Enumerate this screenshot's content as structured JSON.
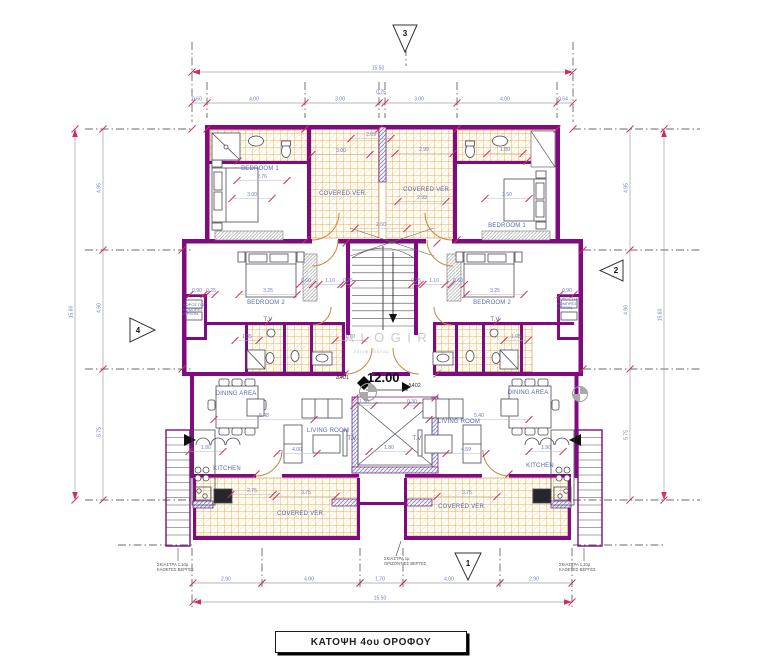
{
  "title_block": {
    "label": "ΚΑΤΟΨΗ  4ου ΟΡΟΦΟΥ"
  },
  "watermark": {
    "name": "KALOGIROU",
    "subtitle": "κατοψ. διανομ."
  },
  "level_marker": {
    "unit_left": "Δ401",
    "unit_right": "Δ402",
    "value": "12.00"
  },
  "markers": [
    {
      "id": "3",
      "points": "393,25 417,25 405,52",
      "tx": 405,
      "ty": 36
    },
    {
      "id": "2",
      "points": "623,260 623,281 600,270.5",
      "tx": 616,
      "ty": 273
    },
    {
      "id": "4",
      "points": "130,318 130,342 155,330",
      "tx": 138,
      "ty": 333
    },
    {
      "id": "1",
      "points": "455,553 481,553 468,580",
      "tx": 468,
      "ty": 566
    }
  ],
  "room_labels": [
    {
      "text": "BEDROOM  1",
      "x": 260,
      "y": 169
    },
    {
      "text": "BEDROOM  1",
      "x": 507,
      "y": 226
    },
    {
      "text": "BEDROOM 2",
      "x": 266,
      "y": 303
    },
    {
      "text": "BEDROOM 2",
      "x": 492,
      "y": 303
    },
    {
      "text": "COVERED VER.",
      "x": 343,
      "y": 194
    },
    {
      "text": "COVERED VER.",
      "x": 427,
      "y": 190
    },
    {
      "text": "COVERED VER.",
      "x": 301,
      "y": 514
    },
    {
      "text": "COVERED VER.",
      "x": 462,
      "y": 507
    },
    {
      "text": "LIVING ROOM",
      "x": 328,
      "y": 431
    },
    {
      "text": "LIVING ROOM",
      "x": 459,
      "y": 422
    },
    {
      "text": "DINING AREA",
      "x": 236,
      "y": 394
    },
    {
      "text": "DINING AREA",
      "x": 528,
      "y": 393
    },
    {
      "text": "KITCHEN",
      "x": 227,
      "y": 469
    },
    {
      "text": "KITCHEN",
      "x": 540,
      "y": 466
    },
    {
      "text": "T.V",
      "x": 268,
      "y": 320
    },
    {
      "text": "T.V",
      "x": 495,
      "y": 320
    },
    {
      "text": "T.V",
      "x": 352,
      "y": 439
    },
    {
      "text": "T.V",
      "x": 417,
      "y": 439
    }
  ],
  "side_notes": [
    {
      "lines": [
        "ΧΩΡΟΣ ΓΙΑ",
        "ΚΟΜΠΡΕΣ.",
        "ΑΙΡΚΟΝ."
      ],
      "x": 183,
      "y": 303
    },
    {
      "lines": [
        "ΧΩΡΟΣ ΓΙΑ",
        "ΚΟΜΠΡΕΣ.",
        "ΑΙΡΚΟΝ."
      ],
      "x": 557,
      "y": 297
    }
  ],
  "shade_notes": [
    {
      "lines": [
        "ΣΚΙΑΣΤΡΑ 1.10μ",
        "ΚΑΘΕΤΕΣ ΒΕΡΓΕΣ"
      ],
      "x": 157,
      "y": 562
    },
    {
      "lines": [
        "ΣΚΙΑΣΤΡΑ 1μ",
        "ΟΡΙΖΟΝΤΙΕΣ ΒΕΡΓΕΣ"
      ],
      "x": 384,
      "y": 556
    },
    {
      "lines": [
        "ΣΚΙΑΣΤΡΑ 1.10μ",
        "ΚΑΘΕΤΕΣ ΒΕΡΓΕΣ"
      ],
      "x": 559,
      "y": 562
    }
  ],
  "dim_chains": [
    {
      "o": "h",
      "y": 72,
      "x1": 192,
      "x2": 573,
      "ticks": [
        192,
        573
      ],
      "arrows": true,
      "labels": [
        {
          "t": "15.50",
          "at": 378
        }
      ]
    },
    {
      "o": "h",
      "y": 103,
      "x1": 192,
      "x2": 573,
      "ticks": [
        192,
        207,
        305,
        379,
        385,
        457,
        557,
        573
      ],
      "labels": [
        {
          "t": "0.60",
          "at": 197
        },
        {
          "t": "4.00",
          "at": 254
        },
        {
          "t": "3.00",
          "at": 340
        },
        {
          "t": "0.25",
          "at": 381,
          "off": -7
        },
        {
          "t": "3.00",
          "at": 419
        },
        {
          "t": "4.00",
          "at": 505
        },
        {
          "t": "0.64",
          "at": 563
        }
      ]
    },
    {
      "o": "h",
      "y": 583,
      "x1": 193,
      "x2": 572,
      "ticks": [
        193,
        262,
        360,
        403,
        500,
        572
      ],
      "labels": [
        {
          "t": "2.90",
          "at": 226
        },
        {
          "t": "4.00",
          "at": 309
        },
        {
          "t": "1.70",
          "at": 380
        },
        {
          "t": "4.00",
          "at": 449
        },
        {
          "t": "2.90",
          "at": 534
        }
      ]
    },
    {
      "o": "h",
      "y": 602,
      "x1": 193,
      "x2": 572,
      "ticks": [
        193,
        572
      ],
      "arrows": true,
      "labels": [
        {
          "t": "15.50",
          "at": 380
        }
      ]
    },
    {
      "o": "v",
      "x": 103,
      "y1": 129,
      "y2": 500,
      "ticks": [
        129,
        250,
        369,
        500
      ],
      "labels": [
        {
          "t": "4.95",
          "at": 188
        },
        {
          "t": "4.90",
          "at": 308
        },
        {
          "t": "5.75",
          "at": 432
        }
      ]
    },
    {
      "o": "v",
      "x": 75,
      "y1": 129,
      "y2": 500,
      "ticks": [
        129,
        500
      ],
      "arrows": true,
      "labels": [
        {
          "t": "15.60",
          "at": 312
        }
      ]
    },
    {
      "o": "v",
      "x": 630,
      "y1": 129,
      "y2": 500,
      "ticks": [
        129,
        250,
        369,
        500
      ],
      "labels": [
        {
          "t": "4.95",
          "at": 188
        },
        {
          "t": "4.90",
          "at": 310
        },
        {
          "t": "5.75",
          "at": 435
        }
      ]
    },
    {
      "o": "v",
      "x": 664,
      "y1": 129,
      "y2": 500,
      "ticks": [
        129,
        500
      ],
      "arrows": true,
      "labels": [
        {
          "t": "15.60",
          "at": 315
        }
      ]
    }
  ],
  "dims": [
    [
      "2.76",
      262,
      178,
      50
    ],
    [
      "2.09",
      371,
      136,
      40
    ],
    [
      "3.00",
      341,
      152,
      58
    ],
    [
      "2.99",
      424,
      151,
      58
    ],
    [
      "1.80",
      505,
      151,
      36
    ],
    [
      "3.00",
      252,
      196,
      40
    ],
    [
      "3.50",
      507,
      196,
      44
    ],
    [
      "2.99",
      422,
      199,
      48
    ],
    [
      "2.60",
      381,
      226,
      52
    ],
    [
      "3.25",
      268,
      292,
      58
    ],
    [
      "0.90",
      197,
      292,
      14
    ],
    [
      "0.25",
      211,
      292,
      8
    ],
    [
      "0.60",
      306,
      282,
      13
    ],
    [
      "1.10",
      330,
      282,
      22
    ],
    [
      "0.25",
      348,
      282,
      8
    ],
    [
      "3.25",
      495,
      292,
      58
    ],
    [
      "0.90",
      567,
      292,
      14
    ],
    [
      "0.25",
      416,
      282,
      8
    ],
    [
      "1.10",
      434,
      282,
      22
    ],
    [
      "0.60",
      458,
      282,
      13
    ],
    [
      "1.05",
      247,
      338,
      24
    ],
    [
      "1.70",
      350,
      338,
      30
    ],
    [
      "1.05",
      516,
      338,
      24
    ],
    [
      "5.48",
      264,
      417,
      100
    ],
    [
      "5.40",
      479,
      417,
      100
    ],
    [
      "4.00",
      297,
      451,
      40
    ],
    [
      "4.59",
      466,
      451,
      40
    ],
    [
      "1.80",
      206,
      449,
      34
    ],
    [
      "1.90",
      546,
      449,
      34
    ],
    [
      "2.75",
      252,
      492,
      42
    ],
    [
      "3.75",
      306,
      494,
      60
    ],
    [
      "3.75",
      467,
      494,
      60
    ],
    [
      "1.30",
      364,
      403,
      20
    ],
    [
      "0.30",
      412,
      403,
      10
    ],
    [
      "1.80",
      389,
      449,
      40
    ]
  ],
  "extra_ticks": [
    [
      207,
      129
    ],
    [
      305,
      129
    ],
    [
      379,
      129
    ],
    [
      457,
      129
    ],
    [
      557,
      129
    ],
    [
      192,
      129
    ],
    [
      573,
      129
    ],
    [
      182,
      250
    ],
    [
      583,
      250
    ],
    [
      182,
      369
    ],
    [
      583,
      369
    ],
    [
      262,
      583
    ],
    [
      360,
      583
    ],
    [
      403,
      583
    ],
    [
      500,
      583
    ],
    [
      346,
      243
    ],
    [
      437,
      243
    ],
    [
      355,
      398
    ],
    [
      435,
      398
    ],
    [
      306,
      240
    ],
    [
      457,
      240
    ],
    [
      345,
      374
    ],
    [
      437,
      374
    ],
    [
      256,
      474
    ],
    [
      509,
      474
    ],
    [
      268,
      322
    ],
    [
      497,
      322
    ],
    [
      238,
      161
    ],
    [
      527,
      161
    ]
  ],
  "axis_lines": [
    [
      85,
      129,
      192,
      129
    ],
    [
      573,
      129,
      700,
      129
    ],
    [
      85,
      250,
      192,
      250
    ],
    [
      583,
      250,
      700,
      250
    ],
    [
      85,
      369,
      192,
      369
    ],
    [
      583,
      369,
      700,
      369
    ],
    [
      85,
      500,
      192,
      500
    ],
    [
      573,
      500,
      700,
      500
    ],
    [
      118,
      545,
      192,
      545
    ],
    [
      573,
      545,
      665,
      545
    ],
    [
      192,
      42,
      192,
      122
    ],
    [
      573,
      42,
      573,
      122
    ],
    [
      192,
      548,
      192,
      610
    ],
    [
      572,
      548,
      572,
      610
    ],
    [
      207,
      82,
      207,
      118
    ],
    [
      305,
      82,
      305,
      118
    ],
    [
      379,
      82,
      379,
      118
    ],
    [
      385,
      82,
      385,
      118
    ],
    [
      457,
      82,
      457,
      118
    ],
    [
      557,
      82,
      557,
      118
    ],
    [
      262,
      548,
      262,
      590
    ],
    [
      360,
      548,
      360,
      590
    ],
    [
      403,
      548,
      403,
      590
    ],
    [
      500,
      548,
      500,
      590
    ],
    [
      406,
      48,
      406,
      66
    ]
  ],
  "leader_lines": [
    [
      401,
      541,
      396,
      556
    ],
    [
      178,
      548,
      178,
      561
    ],
    [
      584,
      548,
      584,
      561
    ]
  ],
  "colors": {
    "wall": "#800b80",
    "tick": "#cc3060",
    "dim_line": "#9aa0a8",
    "dim_text": "#6f7db8",
    "label_text": "#5a69a8",
    "tile_line": "#d79b33",
    "door": "#c8863c",
    "watermark": "#c6c6c6",
    "axis": "#3a3a3a"
  }
}
